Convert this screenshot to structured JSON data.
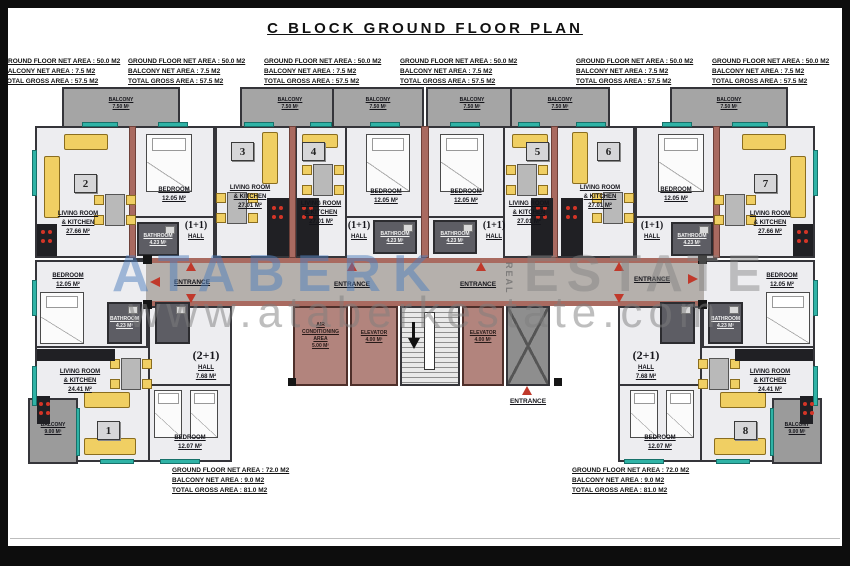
{
  "title": "C BLOCK GROUND FLOOR PLAN",
  "summary_small": {
    "line1": "GROUND FLOOR NET AREA : 50.0 M2",
    "line2": "BALCONY NET AREA : 7.5 M2",
    "line3": "TOTAL GROSS AREA : 57.5 M2"
  },
  "summary_large": {
    "line1": "GROUND FLOOR NET AREA : 72.0 M2",
    "line2": "BALCONY NET AREA : 9.0 M2",
    "line3": "TOTAL GROSS AREA : 81.0 M2"
  },
  "unit_numbers": {
    "u1": "1",
    "u2": "2",
    "u3": "3",
    "u4": "4",
    "u5": "5",
    "u6": "6",
    "u7": "7",
    "u8": "8"
  },
  "rooms": {
    "balcony": "BALCONY",
    "balcony_area_top": "7.50 M²",
    "balcony_area_bottom": "9.00 M²",
    "living_line1": "LIVING ROOM",
    "living_line2": "& KITCHEN",
    "living_area_corner": "27.66 M²",
    "living_area_mid": "27.01 M²",
    "living_area_bottom": "24.41 M²",
    "bedroom": "BEDROOM",
    "bedroom_area": "12.05 M²",
    "bedroom_area_alt": "12.07 M²",
    "hall": "HALL",
    "hall_area": "7.68 M²",
    "type_one_plus_one": "(1+1)",
    "type_two_plus_one": "(2+1)",
    "bathroom": "BATHROOM",
    "bathroom_area": "4.23 M²",
    "entrance": "ENTRANCE",
    "elevator": "ELEVATOR",
    "elevator_area": "4.00 M²",
    "ac_line1": "AIR",
    "ac_line2": "CONDITIONING",
    "ac_line3": "AREA",
    "ac_area": "5.00 M²"
  },
  "watermark": {
    "brand_primary": "ATABERK",
    "brand_secondary": "ESTATE",
    "brand_vertical": "REAL",
    "website": "www.ataberkestate.com"
  },
  "colors": {
    "wall_dark": "#35353a",
    "wall_accent": "#a96a60",
    "window_teal": "#2fb3a6",
    "furniture_yellow": "#f0cf63",
    "arrow_red": "#c0392b",
    "watermark_blue": "#4d7ebc"
  }
}
